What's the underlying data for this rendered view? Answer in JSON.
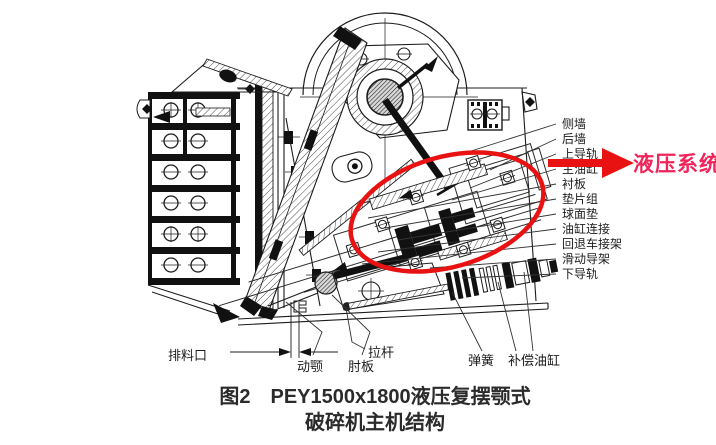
{
  "figure": {
    "caption_line1": "图2　PEY1500x1800液压复摆颚式",
    "caption_line2": "破碎机主机结构"
  },
  "annotation": {
    "text": "液压系统",
    "text_color": "#f0245a",
    "shape_color": "#e81212"
  },
  "part_labels": {
    "right": [
      "侧墙",
      "后墙",
      "上导轨",
      "主油缸",
      "衬板",
      "垫片组",
      "球面垫",
      "油缸连接",
      "回退车接架",
      "滑动导架",
      "下导轨"
    ],
    "bottom": [
      "排料口",
      "动颚",
      "肘板",
      "拉杆",
      "弹簧",
      "补偿油缸"
    ]
  },
  "line_color": "#1c1c1c"
}
